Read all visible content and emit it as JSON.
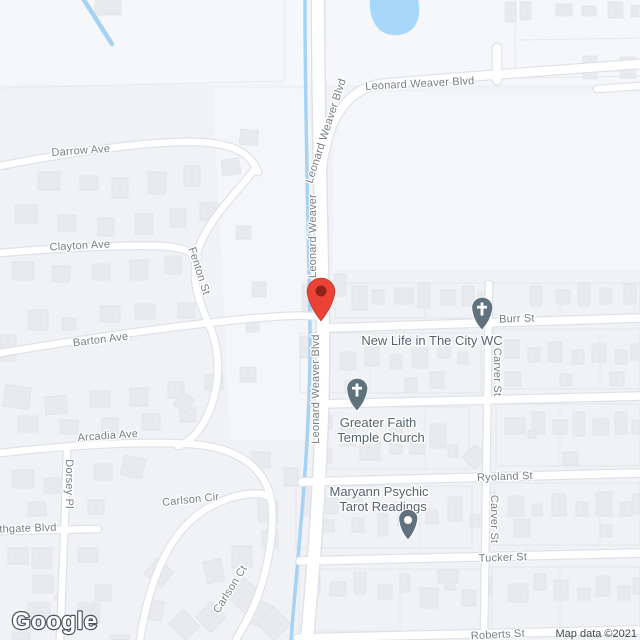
{
  "map": {
    "watermark": "Google",
    "attribution": "Map data ©2021",
    "colors": {
      "land": "#F0F2F5",
      "land_light": "#F6F7FA",
      "water": "#A6D3F4",
      "pond": "#A8D8F9",
      "road": "#FFFFFF",
      "building": "#E8EAEE",
      "building_edge": "#DDE0E6",
      "street_label": "#777E88",
      "poi_label": "#55646F",
      "marker_red": "#EA4335",
      "marker_red_dark": "#8E2418",
      "poi_pin_gray": "#61727F"
    },
    "marker": {
      "type": "red-location-marker"
    },
    "streets": [
      {
        "label": "Leonard Weaver Blvd"
      },
      {
        "label": "Leonard Weaver Blvd"
      },
      {
        "label": "Leonard Weaver"
      },
      {
        "label": "Leonard Weaver Blvd"
      },
      {
        "label": "Darrow Ave"
      },
      {
        "label": "Clayton Ave"
      },
      {
        "label": "Fenton St"
      },
      {
        "label": "Barton Ave"
      },
      {
        "label": "Arcadia Ave"
      },
      {
        "label": "Dorsey Pl"
      },
      {
        "label": "Southgate Blvd"
      },
      {
        "label": "Carlson Cir"
      },
      {
        "label": "Carlson Ct"
      },
      {
        "label": "Burr St"
      },
      {
        "label": "Carver St"
      },
      {
        "label": "Carver St"
      },
      {
        "label": "Ryoland St"
      },
      {
        "label": "Tucker St"
      },
      {
        "label": "Roberts St"
      }
    ],
    "pois": [
      {
        "name": "New Life in The City WC",
        "lines": [
          "New Life in The City WC"
        ],
        "icon": "church"
      },
      {
        "name": "Greater Faith Temple Church",
        "lines": [
          "Greater Faith",
          "Temple Church"
        ],
        "icon": "church"
      },
      {
        "name": "Maryann Psychic Tarot Readings",
        "lines": [
          "Maryann Psychic",
          "Tarot Readings"
        ],
        "icon": "generic-pin"
      }
    ],
    "buildings": [
      [
        95,
        0,
        26,
        15,
        0
      ],
      [
        505,
        2,
        11,
        20,
        0
      ],
      [
        520,
        2,
        11,
        18,
        0
      ],
      [
        556,
        4,
        16,
        12,
        0
      ],
      [
        582,
        6,
        14,
        10,
        0
      ],
      [
        608,
        2,
        15,
        16,
        0
      ],
      [
        631,
        5,
        8,
        12,
        0
      ],
      [
        583,
        56,
        14,
        23,
        0
      ],
      [
        620,
        57,
        16,
        21,
        0
      ],
      [
        38,
        172,
        22,
        18,
        0
      ],
      [
        80,
        176,
        18,
        14,
        0
      ],
      [
        112,
        178,
        16,
        20,
        0
      ],
      [
        148,
        172,
        18,
        22,
        0
      ],
      [
        184,
        166,
        16,
        20,
        0
      ],
      [
        222,
        159,
        18,
        16,
        -8
      ],
      [
        15,
        205,
        22,
        18,
        0
      ],
      [
        58,
        215,
        18,
        16,
        0
      ],
      [
        98,
        218,
        16,
        18,
        0
      ],
      [
        135,
        214,
        18,
        20,
        0
      ],
      [
        170,
        209,
        16,
        18,
        0
      ],
      [
        200,
        203,
        18,
        17,
        0
      ],
      [
        12,
        262,
        22,
        18,
        0
      ],
      [
        52,
        266,
        18,
        16,
        0
      ],
      [
        92,
        264,
        18,
        16,
        0
      ],
      [
        130,
        260,
        18,
        20,
        0
      ],
      [
        165,
        256,
        16,
        18,
        0
      ],
      [
        28,
        310,
        20,
        20,
        0
      ],
      [
        62,
        318,
        14,
        12,
        0
      ],
      [
        100,
        306,
        20,
        16,
        0
      ],
      [
        135,
        304,
        20,
        15,
        0
      ],
      [
        178,
        303,
        17,
        15,
        0
      ],
      [
        0,
        335,
        16,
        26,
        0
      ],
      [
        240,
        130,
        18,
        15,
        5
      ],
      [
        236,
        226,
        15,
        13,
        0
      ],
      [
        252,
        282,
        14,
        15,
        0
      ],
      [
        246,
        318,
        13,
        14,
        0
      ],
      [
        334,
        274,
        12,
        22,
        0
      ],
      [
        4,
        386,
        26,
        22,
        8
      ],
      [
        45,
        396,
        22,
        18,
        -6
      ],
      [
        90,
        391,
        20,
        16,
        0
      ],
      [
        130,
        388,
        18,
        18,
        0
      ],
      [
        168,
        382,
        16,
        16,
        0
      ],
      [
        205,
        374,
        18,
        16,
        0
      ],
      [
        240,
        367,
        16,
        15,
        0
      ],
      [
        18,
        416,
        20,
        16,
        0
      ],
      [
        60,
        420,
        18,
        14,
        0
      ],
      [
        102,
        418,
        16,
        16,
        0
      ],
      [
        142,
        414,
        18,
        16,
        0
      ],
      [
        180,
        408,
        16,
        14,
        0
      ],
      [
        176,
        394,
        16,
        16,
        28
      ],
      [
        12,
        470,
        22,
        18,
        0
      ],
      [
        44,
        478,
        18,
        15,
        0
      ],
      [
        94,
        464,
        18,
        16,
        0
      ],
      [
        122,
        457,
        22,
        20,
        12
      ],
      [
        28,
        502,
        18,
        14,
        0
      ],
      [
        88,
        500,
        16,
        14,
        0
      ],
      [
        252,
        452,
        18,
        16,
        0
      ],
      [
        284,
        468,
        14,
        18,
        0
      ],
      [
        258,
        500,
        20,
        22,
        0
      ],
      [
        8,
        548,
        20,
        16,
        0
      ],
      [
        32,
        548,
        20,
        20,
        0
      ],
      [
        78,
        548,
        20,
        14,
        0
      ],
      [
        33,
        575,
        20,
        18,
        0
      ],
      [
        28,
        603,
        22,
        20,
        0
      ],
      [
        78,
        603,
        22,
        20,
        0
      ],
      [
        95,
        585,
        16,
        16,
        0
      ],
      [
        12,
        632,
        18,
        8,
        0
      ],
      [
        143,
        600,
        20,
        20,
        10
      ],
      [
        172,
        615,
        24,
        20,
        45
      ],
      [
        200,
        606,
        22,
        22,
        45
      ],
      [
        247,
        601,
        23,
        25,
        20
      ],
      [
        148,
        563,
        22,
        20,
        40
      ],
      [
        205,
        560,
        18,
        22,
        -12
      ],
      [
        232,
        583,
        26,
        26,
        42
      ],
      [
        262,
        612,
        24,
        24,
        45
      ],
      [
        56,
        593,
        9,
        9,
        45
      ],
      [
        110,
        635,
        20,
        5,
        0
      ],
      [
        232,
        546,
        20,
        22,
        0
      ],
      [
        262,
        530,
        16,
        18,
        0
      ],
      [
        302,
        284,
        15,
        28,
        0
      ],
      [
        352,
        286,
        15,
        24,
        0
      ],
      [
        372,
        290,
        12,
        14,
        0
      ],
      [
        395,
        288,
        18,
        16,
        0
      ],
      [
        418,
        284,
        12,
        24,
        0
      ],
      [
        441,
        290,
        14,
        15,
        0
      ],
      [
        462,
        286,
        12,
        20,
        0
      ],
      [
        478,
        292,
        10,
        12,
        0
      ],
      [
        530,
        286,
        12,
        20,
        0
      ],
      [
        556,
        290,
        14,
        14,
        0
      ],
      [
        578,
        284,
        12,
        22,
        0
      ],
      [
        600,
        288,
        12,
        16,
        0
      ],
      [
        624,
        284,
        12,
        20,
        0
      ],
      [
        300,
        336,
        14,
        22,
        0
      ],
      [
        318,
        360,
        12,
        14,
        0
      ],
      [
        340,
        352,
        16,
        18,
        0
      ],
      [
        365,
        344,
        14,
        22,
        0
      ],
      [
        390,
        355,
        12,
        14,
        0
      ],
      [
        412,
        348,
        16,
        20,
        0
      ],
      [
        438,
        342,
        12,
        16,
        0
      ],
      [
        345,
        380,
        14,
        12,
        0
      ],
      [
        405,
        378,
        12,
        14,
        0
      ],
      [
        430,
        372,
        14,
        16,
        0
      ],
      [
        458,
        352,
        10,
        12,
        0
      ],
      [
        505,
        340,
        14,
        18,
        0
      ],
      [
        528,
        348,
        12,
        14,
        0
      ],
      [
        548,
        342,
        14,
        20,
        0
      ],
      [
        572,
        350,
        12,
        14,
        0
      ],
      [
        592,
        344,
        14,
        18,
        0
      ],
      [
        615,
        350,
        12,
        14,
        0
      ],
      [
        631,
        344,
        9,
        16,
        0
      ],
      [
        505,
        372,
        16,
        14,
        0
      ],
      [
        560,
        374,
        12,
        12,
        0
      ],
      [
        610,
        372,
        14,
        14,
        0
      ],
      [
        312,
        415,
        20,
        14,
        0
      ],
      [
        340,
        428,
        16,
        18,
        0
      ],
      [
        318,
        448,
        14,
        16,
        0
      ],
      [
        360,
        438,
        20,
        22,
        0
      ],
      [
        390,
        428,
        12,
        26,
        0
      ],
      [
        410,
        438,
        14,
        16,
        0
      ],
      [
        430,
        424,
        16,
        24,
        0
      ],
      [
        448,
        445,
        10,
        12,
        0
      ],
      [
        466,
        448,
        18,
        18,
        45
      ],
      [
        505,
        418,
        20,
        16,
        0
      ],
      [
        532,
        412,
        13,
        22,
        0
      ],
      [
        553,
        420,
        14,
        14,
        0
      ],
      [
        573,
        412,
        12,
        24,
        0
      ],
      [
        593,
        419,
        16,
        16,
        0
      ],
      [
        615,
        412,
        12,
        22,
        0
      ],
      [
        632,
        420,
        8,
        14,
        0
      ],
      [
        528,
        430,
        8,
        8,
        0
      ],
      [
        563,
        452,
        15,
        13,
        0
      ],
      [
        302,
        488,
        18,
        28,
        0
      ],
      [
        326,
        498,
        12,
        16,
        0
      ],
      [
        346,
        492,
        16,
        18,
        0
      ],
      [
        320,
        520,
        14,
        12,
        0
      ],
      [
        352,
        518,
        12,
        14,
        0
      ],
      [
        378,
        514,
        10,
        22,
        0
      ],
      [
        398,
        506,
        16,
        20,
        0
      ],
      [
        426,
        510,
        12,
        14,
        0
      ],
      [
        448,
        497,
        14,
        24,
        0
      ],
      [
        470,
        515,
        10,
        12,
        0
      ],
      [
        484,
        492,
        12,
        26,
        0
      ],
      [
        508,
        496,
        16,
        20,
        0
      ],
      [
        532,
        504,
        10,
        12,
        0
      ],
      [
        552,
        494,
        14,
        22,
        0
      ],
      [
        576,
        502,
        12,
        14,
        0
      ],
      [
        596,
        492,
        16,
        24,
        0
      ],
      [
        620,
        502,
        12,
        14,
        0
      ],
      [
        633,
        494,
        7,
        20,
        0
      ],
      [
        514,
        519,
        16,
        18,
        0
      ],
      [
        600,
        525,
        12,
        12,
        0
      ],
      [
        306,
        575,
        14,
        20,
        0
      ],
      [
        330,
        582,
        16,
        14,
        0
      ],
      [
        354,
        572,
        12,
        22,
        0
      ],
      [
        378,
        585,
        14,
        14,
        0
      ],
      [
        400,
        574,
        10,
        18,
        0
      ],
      [
        420,
        588,
        18,
        20,
        0
      ],
      [
        445,
        576,
        10,
        14,
        0
      ],
      [
        462,
        590,
        14,
        16,
        0
      ],
      [
        482,
        578,
        10,
        18,
        0
      ],
      [
        508,
        584,
        20,
        18,
        0
      ],
      [
        534,
        574,
        12,
        16,
        0
      ],
      [
        554,
        580,
        14,
        20,
        0
      ],
      [
        578,
        588,
        12,
        12,
        0
      ],
      [
        596,
        576,
        14,
        20,
        0
      ],
      [
        618,
        586,
        12,
        14,
        0
      ],
      [
        633,
        578,
        7,
        16,
        0
      ],
      [
        438,
        570,
        20,
        13,
        0
      ]
    ]
  }
}
